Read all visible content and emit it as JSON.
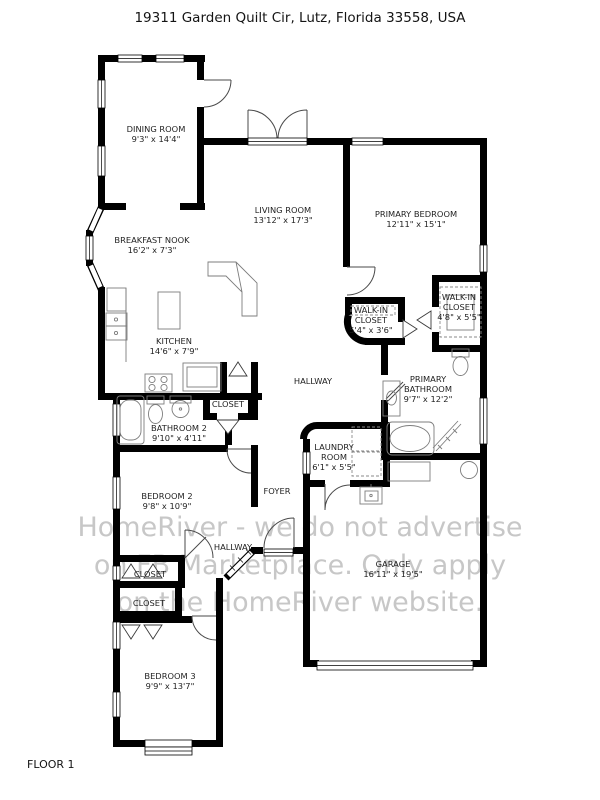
{
  "header": {
    "title": "19311 Garden Quilt Cir, Lutz, Florida 33558, USA"
  },
  "footer": {
    "floor_label": "FLOOR 1"
  },
  "watermark": {
    "lines": [
      "HomeRiver - we do not advertise",
      "on FB Marketplace. Only apply",
      "on the HomeRiver website."
    ],
    "color": "#c7c7c7"
  },
  "floorplan": {
    "wall_color": "#000000",
    "fixture_color": "#7d7d7d",
    "label_color": "#1f1f1f",
    "rooms": [
      {
        "id": "dining-room",
        "lines": [
          "DINING ROOM",
          "9'3\" x 14'4\""
        ],
        "x": 156,
        "y": 132
      },
      {
        "id": "living-room",
        "lines": [
          "LIVING ROOM",
          "13'12\" x 17'3\""
        ],
        "x": 283,
        "y": 213
      },
      {
        "id": "primary-bedroom",
        "lines": [
          "PRIMARY BEDROOM",
          "12'11\" x 15'1\""
        ],
        "x": 416,
        "y": 217
      },
      {
        "id": "breakfast-nook",
        "lines": [
          "BREAKFAST NOOK",
          "16'2\" x 7'3\""
        ],
        "x": 152,
        "y": 243
      },
      {
        "id": "kitchen",
        "lines": [
          "KITCHEN",
          "14'6\" x 7'9\""
        ],
        "x": 174,
        "y": 344
      },
      {
        "id": "walk-in-closet-1",
        "lines": [
          "WALK-IN",
          "CLOSET",
          "5'4\" x 3'6\""
        ],
        "x": 371,
        "y": 313
      },
      {
        "id": "walk-in-closet-2",
        "lines": [
          "WALK-IN",
          "CLOSET",
          "4'8\" x 5'5\""
        ],
        "x": 459,
        "y": 300
      },
      {
        "id": "hallway",
        "lines": [
          "HALLWAY"
        ],
        "x": 313,
        "y": 384
      },
      {
        "id": "primary-bathroom",
        "lines": [
          "PRIMARY",
          "BATHROOM",
          "9'7\" x 12'2\""
        ],
        "x": 428,
        "y": 382
      },
      {
        "id": "closet-hall",
        "lines": [
          "CLOSET"
        ],
        "x": 228,
        "y": 407
      },
      {
        "id": "bathroom-2",
        "lines": [
          "BATHROOM 2",
          "9'10\" x 4'11\""
        ],
        "x": 179,
        "y": 431
      },
      {
        "id": "laundry-room",
        "lines": [
          "LAUNDRY",
          "ROOM",
          "6'1\" x 5'5\""
        ],
        "x": 334,
        "y": 450
      },
      {
        "id": "bedroom-2",
        "lines": [
          "BEDROOM 2",
          "9'8\" x 10'9\""
        ],
        "x": 167,
        "y": 499
      },
      {
        "id": "foyer",
        "lines": [
          "FOYER"
        ],
        "x": 277,
        "y": 494
      },
      {
        "id": "hallway-2",
        "lines": [
          "HALLWAY"
        ],
        "x": 233,
        "y": 550
      },
      {
        "id": "closet-1",
        "lines": [
          "CLOSET"
        ],
        "x": 150,
        "y": 577
      },
      {
        "id": "closet-2",
        "lines": [
          "CLOSET"
        ],
        "x": 149,
        "y": 606
      },
      {
        "id": "garage",
        "lines": [
          "GARAGE",
          "16'11\" x 19'5\""
        ],
        "x": 393,
        "y": 567
      },
      {
        "id": "bedroom-3",
        "lines": [
          "BEDROOM 3",
          "9'9\" x 13'7\""
        ],
        "x": 170,
        "y": 679
      }
    ]
  }
}
